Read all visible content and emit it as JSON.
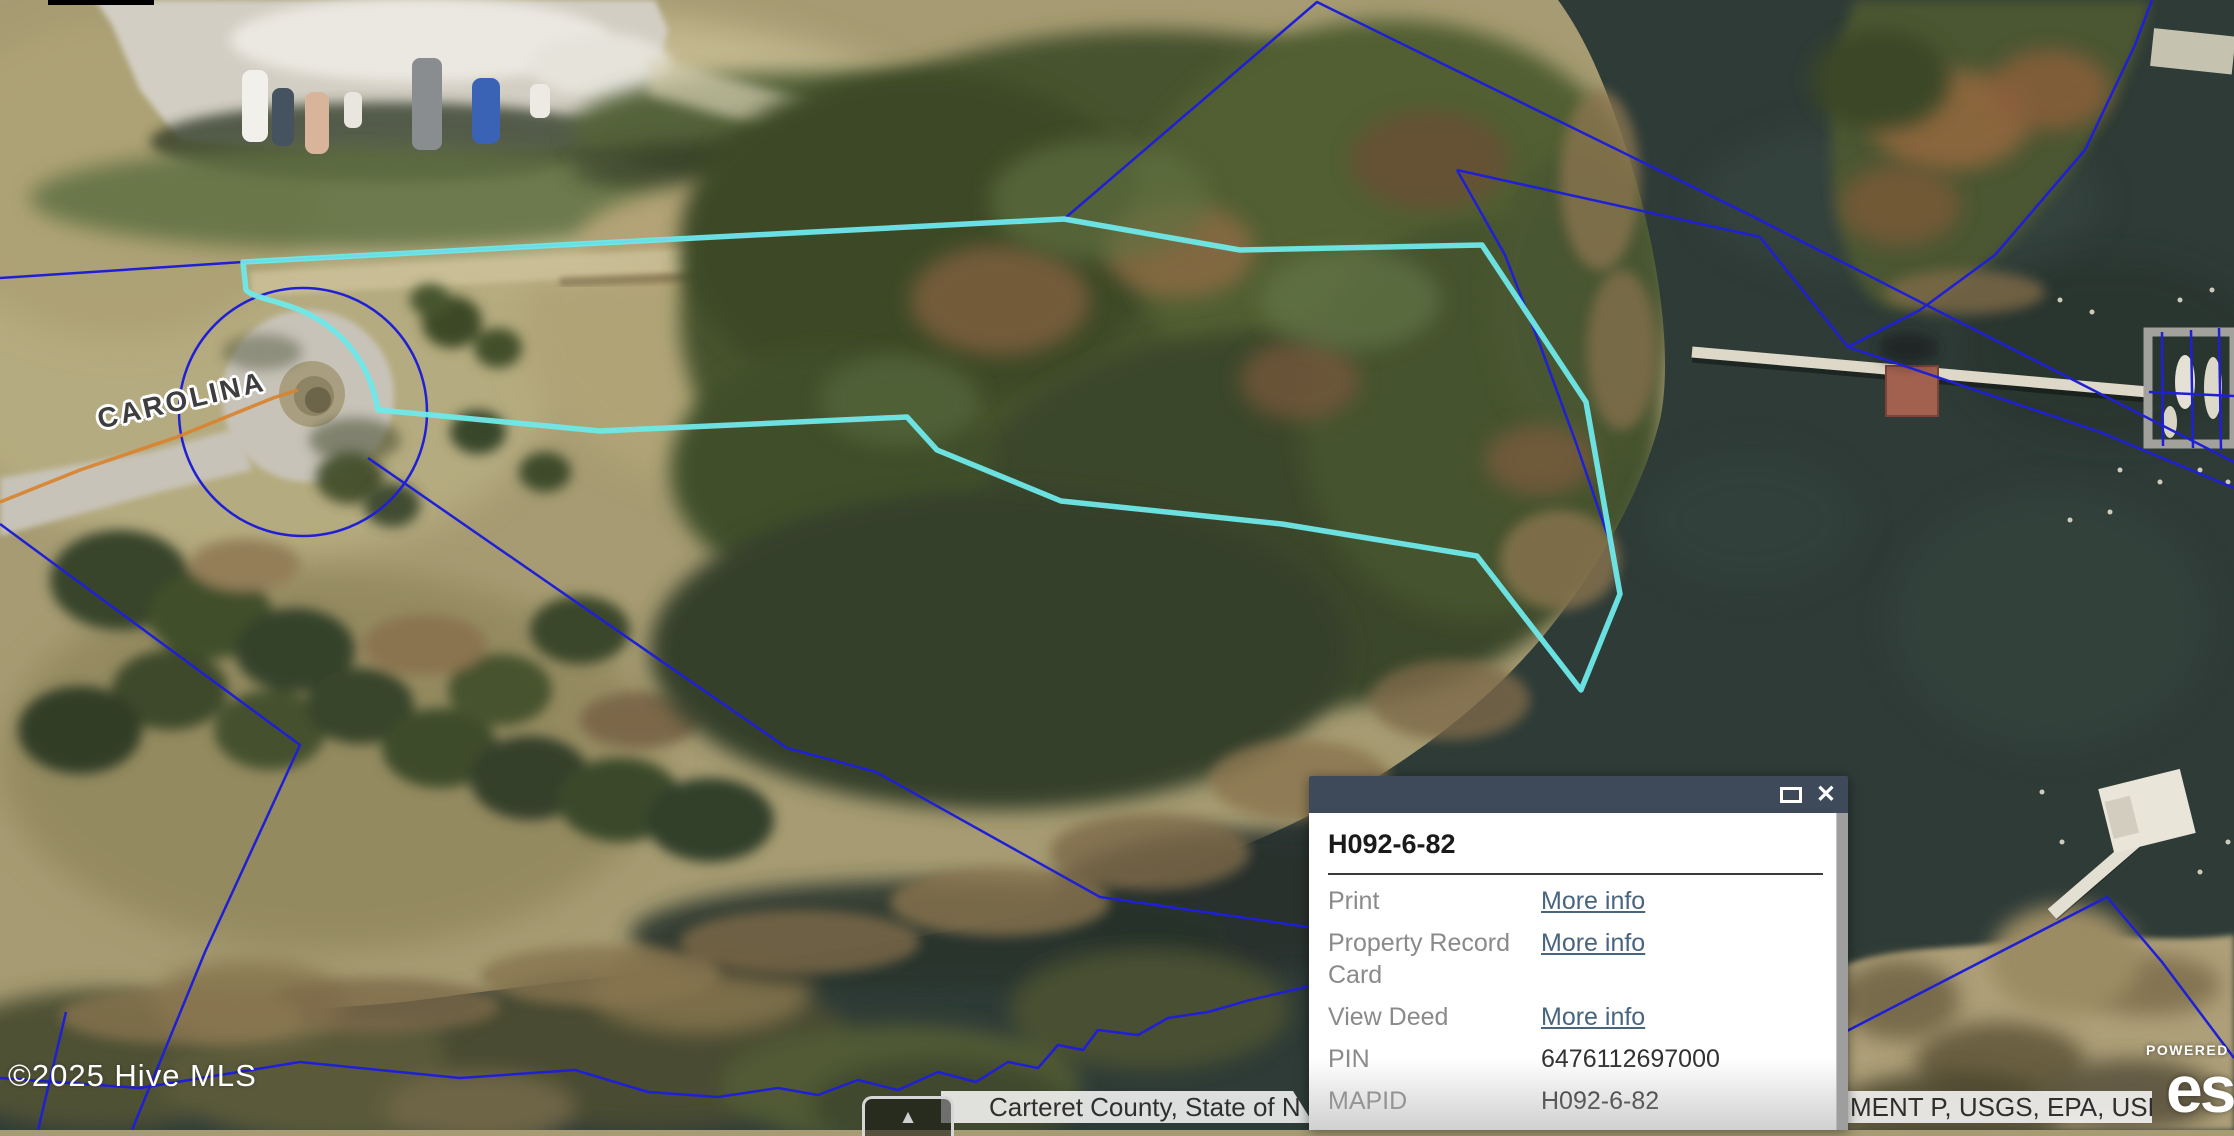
{
  "map": {
    "street_label": "CAROLINA",
    "copyright_text": "©2025 Hive MLS",
    "attribution": {
      "left_text": "Carteret County, State of N",
      "right_text": "MENT P, USGS, EPA, USDA",
      "expander_icon": "▲"
    },
    "esri": {
      "powered_by": "POWERED",
      "logo_text": "esri"
    }
  },
  "popup": {
    "title": "H092-6-82",
    "close_glyph": "✕",
    "rows": [
      {
        "label": "Print",
        "value": "More info"
      },
      {
        "label": "Property Record Card",
        "value": "More info"
      },
      {
        "label": "View Deed",
        "value": "More info"
      },
      {
        "label": "PIN",
        "value": "6476112697000"
      },
      {
        "label": "MAPID",
        "value": "H092-6-82"
      }
    ]
  },
  "colors": {
    "parcel_highlight": "#6FE9E9",
    "parcel_boundary": "#1F1FD6",
    "road_centerline": "#D9822B",
    "popup_header": "#3E4A59",
    "link": "#48647F"
  }
}
